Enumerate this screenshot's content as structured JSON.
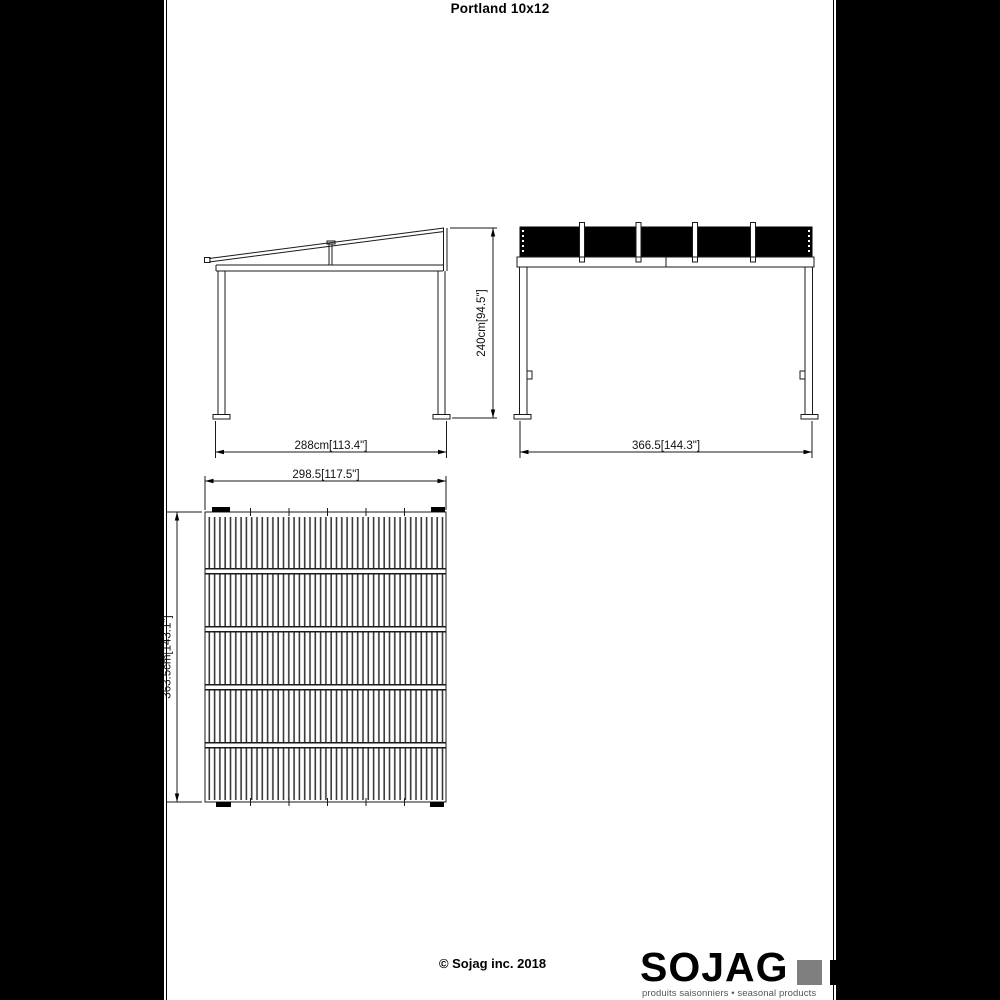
{
  "page": {
    "title": "Portland 10x12",
    "copyright": "© Sojag inc. 2018"
  },
  "brand": {
    "name": "SOJAG",
    "tagline": "produits saisonniers • seasonal products",
    "gray_square_color": "#7f7f7f"
  },
  "drawing": {
    "line_color": "#000000",
    "background_color": "#ffffff",
    "views": {
      "side": {
        "width": "288cm[113.4\"]",
        "height": "240cm[94.5\"]"
      },
      "front": {
        "width": "366.5[144.3\"]",
        "roof_panel_count": 5
      },
      "top": {
        "width": "298.5[117.5\"]",
        "depth": "363.5cm[143.1\"]",
        "roof_section_count": 5
      }
    }
  }
}
